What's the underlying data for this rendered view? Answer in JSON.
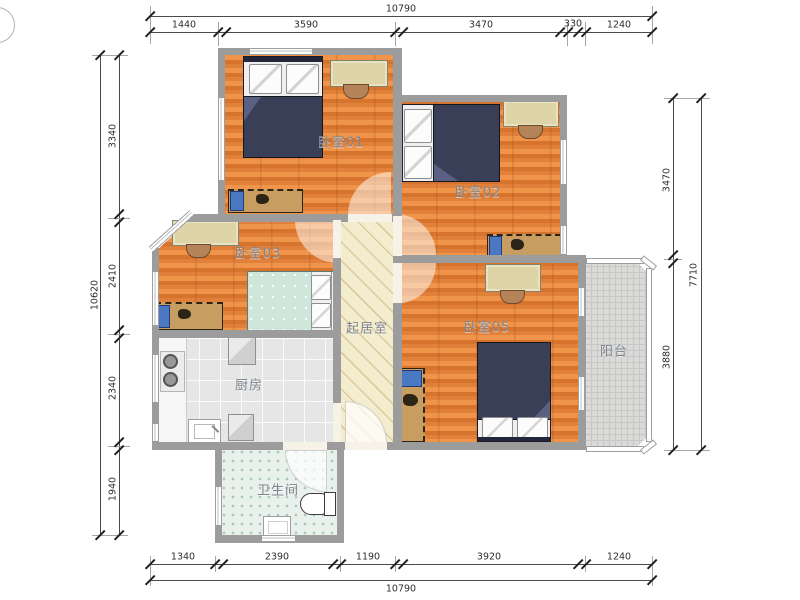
{
  "rooms": {
    "bedroom01": "卧室01",
    "bedroom02": "卧室02",
    "bedroom03": "卧室03",
    "bedroom05": "卧室05",
    "living_room": "起居室",
    "kitchen": "厨房",
    "bathroom": "卫生间",
    "balcony": "阳台"
  },
  "dimensions": {
    "top": {
      "total": "10790",
      "segments": [
        "1440",
        "3590",
        "3470",
        "330",
        "1240"
      ]
    },
    "bottom": {
      "total": "10790",
      "segments": [
        "1340",
        "2390",
        "1190",
        "3920",
        "1240"
      ]
    },
    "left": {
      "total": "10620",
      "segments": [
        "3340",
        "2410",
        "2340",
        "1940"
      ]
    },
    "right": {
      "total": "7710",
      "segments": [
        "3470",
        "3880"
      ]
    }
  },
  "colors": {
    "wall": "#9c9c9c",
    "wood_floor": "#e0803a",
    "living_floor": "#f4edcd",
    "kitchen_floor": "#e6e6e6",
    "bathroom_floor": "#e8f1ec",
    "balcony_floor": "#dadad8",
    "duvet_navy": "#3a3f58",
    "duvet_mint": "#cfe7da",
    "label_gray": "#7c838e"
  }
}
